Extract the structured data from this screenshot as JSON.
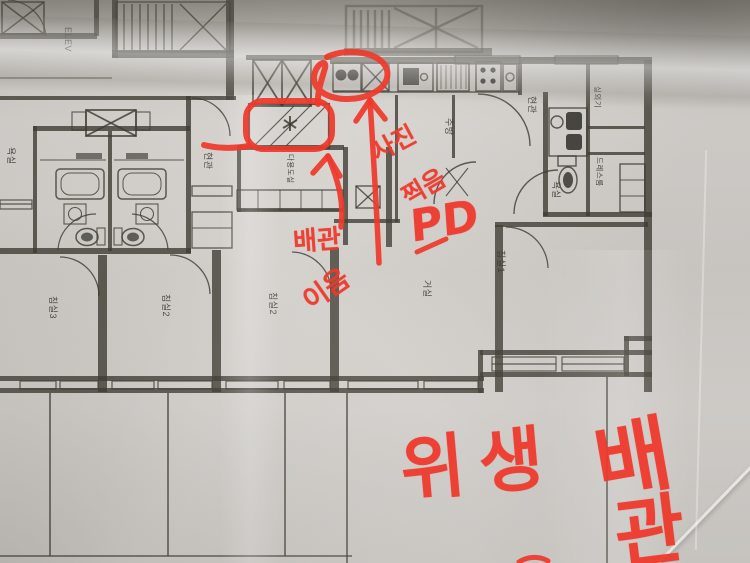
{
  "photo": {
    "kind": "annotated floor plan photo",
    "paper_color": "#d4d1cd",
    "ink_color": "#3f3c33",
    "marker_color": "#ee392b"
  },
  "plan": {
    "labels": {
      "elevator": "ELEV",
      "side_room_left": "욕실",
      "entrance_left": "현관",
      "utility_center": "다용도실",
      "kitchen": "주방",
      "entrance_right": "현관",
      "bathroom_right": "욕실",
      "outdoor_unit": "실외기",
      "dress_room": "드레스룸",
      "bedroom3": "침실3",
      "bedroom2_left": "침실2",
      "bedroom2_right": "침실2",
      "living_room": "거실",
      "bedroom1": "침실1"
    }
  },
  "annotations": {
    "pipe_label": "배관",
    "pipe_scribble": "이음",
    "photo_note_word1": "사진",
    "photo_note_word2": "찍음",
    "pd_label": "PD",
    "sanitary_word1": "위생",
    "sanitary_word2": "배",
    "sanitary_word3": "관"
  }
}
